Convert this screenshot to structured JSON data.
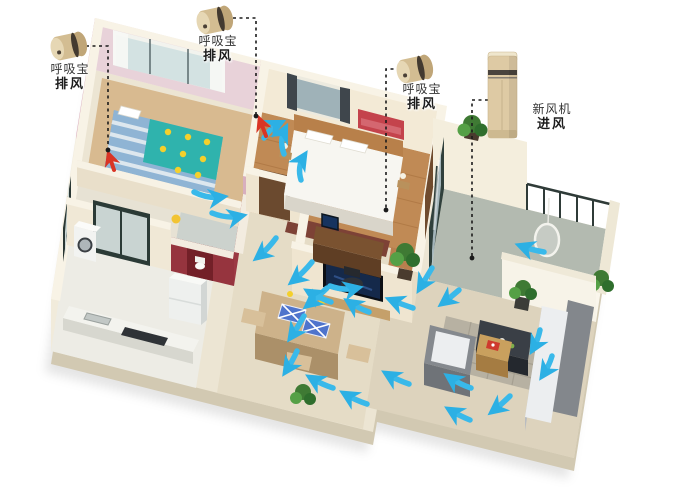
{
  "callouts": {
    "exhaust_left": {
      "line1": "呼吸宝",
      "line2": "排风"
    },
    "exhaust_top": {
      "line1": "呼吸宝",
      "line2": "排风"
    },
    "exhaust_right": {
      "line1": "呼吸宝",
      "line2": "排风"
    },
    "fresh_air": {
      "line1": "新风机",
      "line2": "进风"
    }
  },
  "icons": {
    "exhaust_device": "gold-cylinder-exhaust-vent",
    "fresh_air_unit": "floor-standing-fresh-air-tower",
    "airflow_arrow": "curved-cyan-arrow",
    "exhaust_point_arrow": "red-up-arrow",
    "leader": "black-dashed-line-with-dot"
  },
  "colors": {
    "background": "#ffffff",
    "airflow_arrow": "#39b9ea",
    "exhaust_arrow": "#d93425",
    "leader_line": "#1b1b1b",
    "label_text": "#2b2b2b",
    "device_gold": "#d3bd92",
    "fresh_air_unit_body": "#decaa4",
    "wall_cream": "#f0e8d6",
    "wall_pink": "#d8a9ba",
    "bathroom_red": "#96343e",
    "floor_wood": "#c08a55",
    "floor_tile": "#e5dcc6"
  }
}
